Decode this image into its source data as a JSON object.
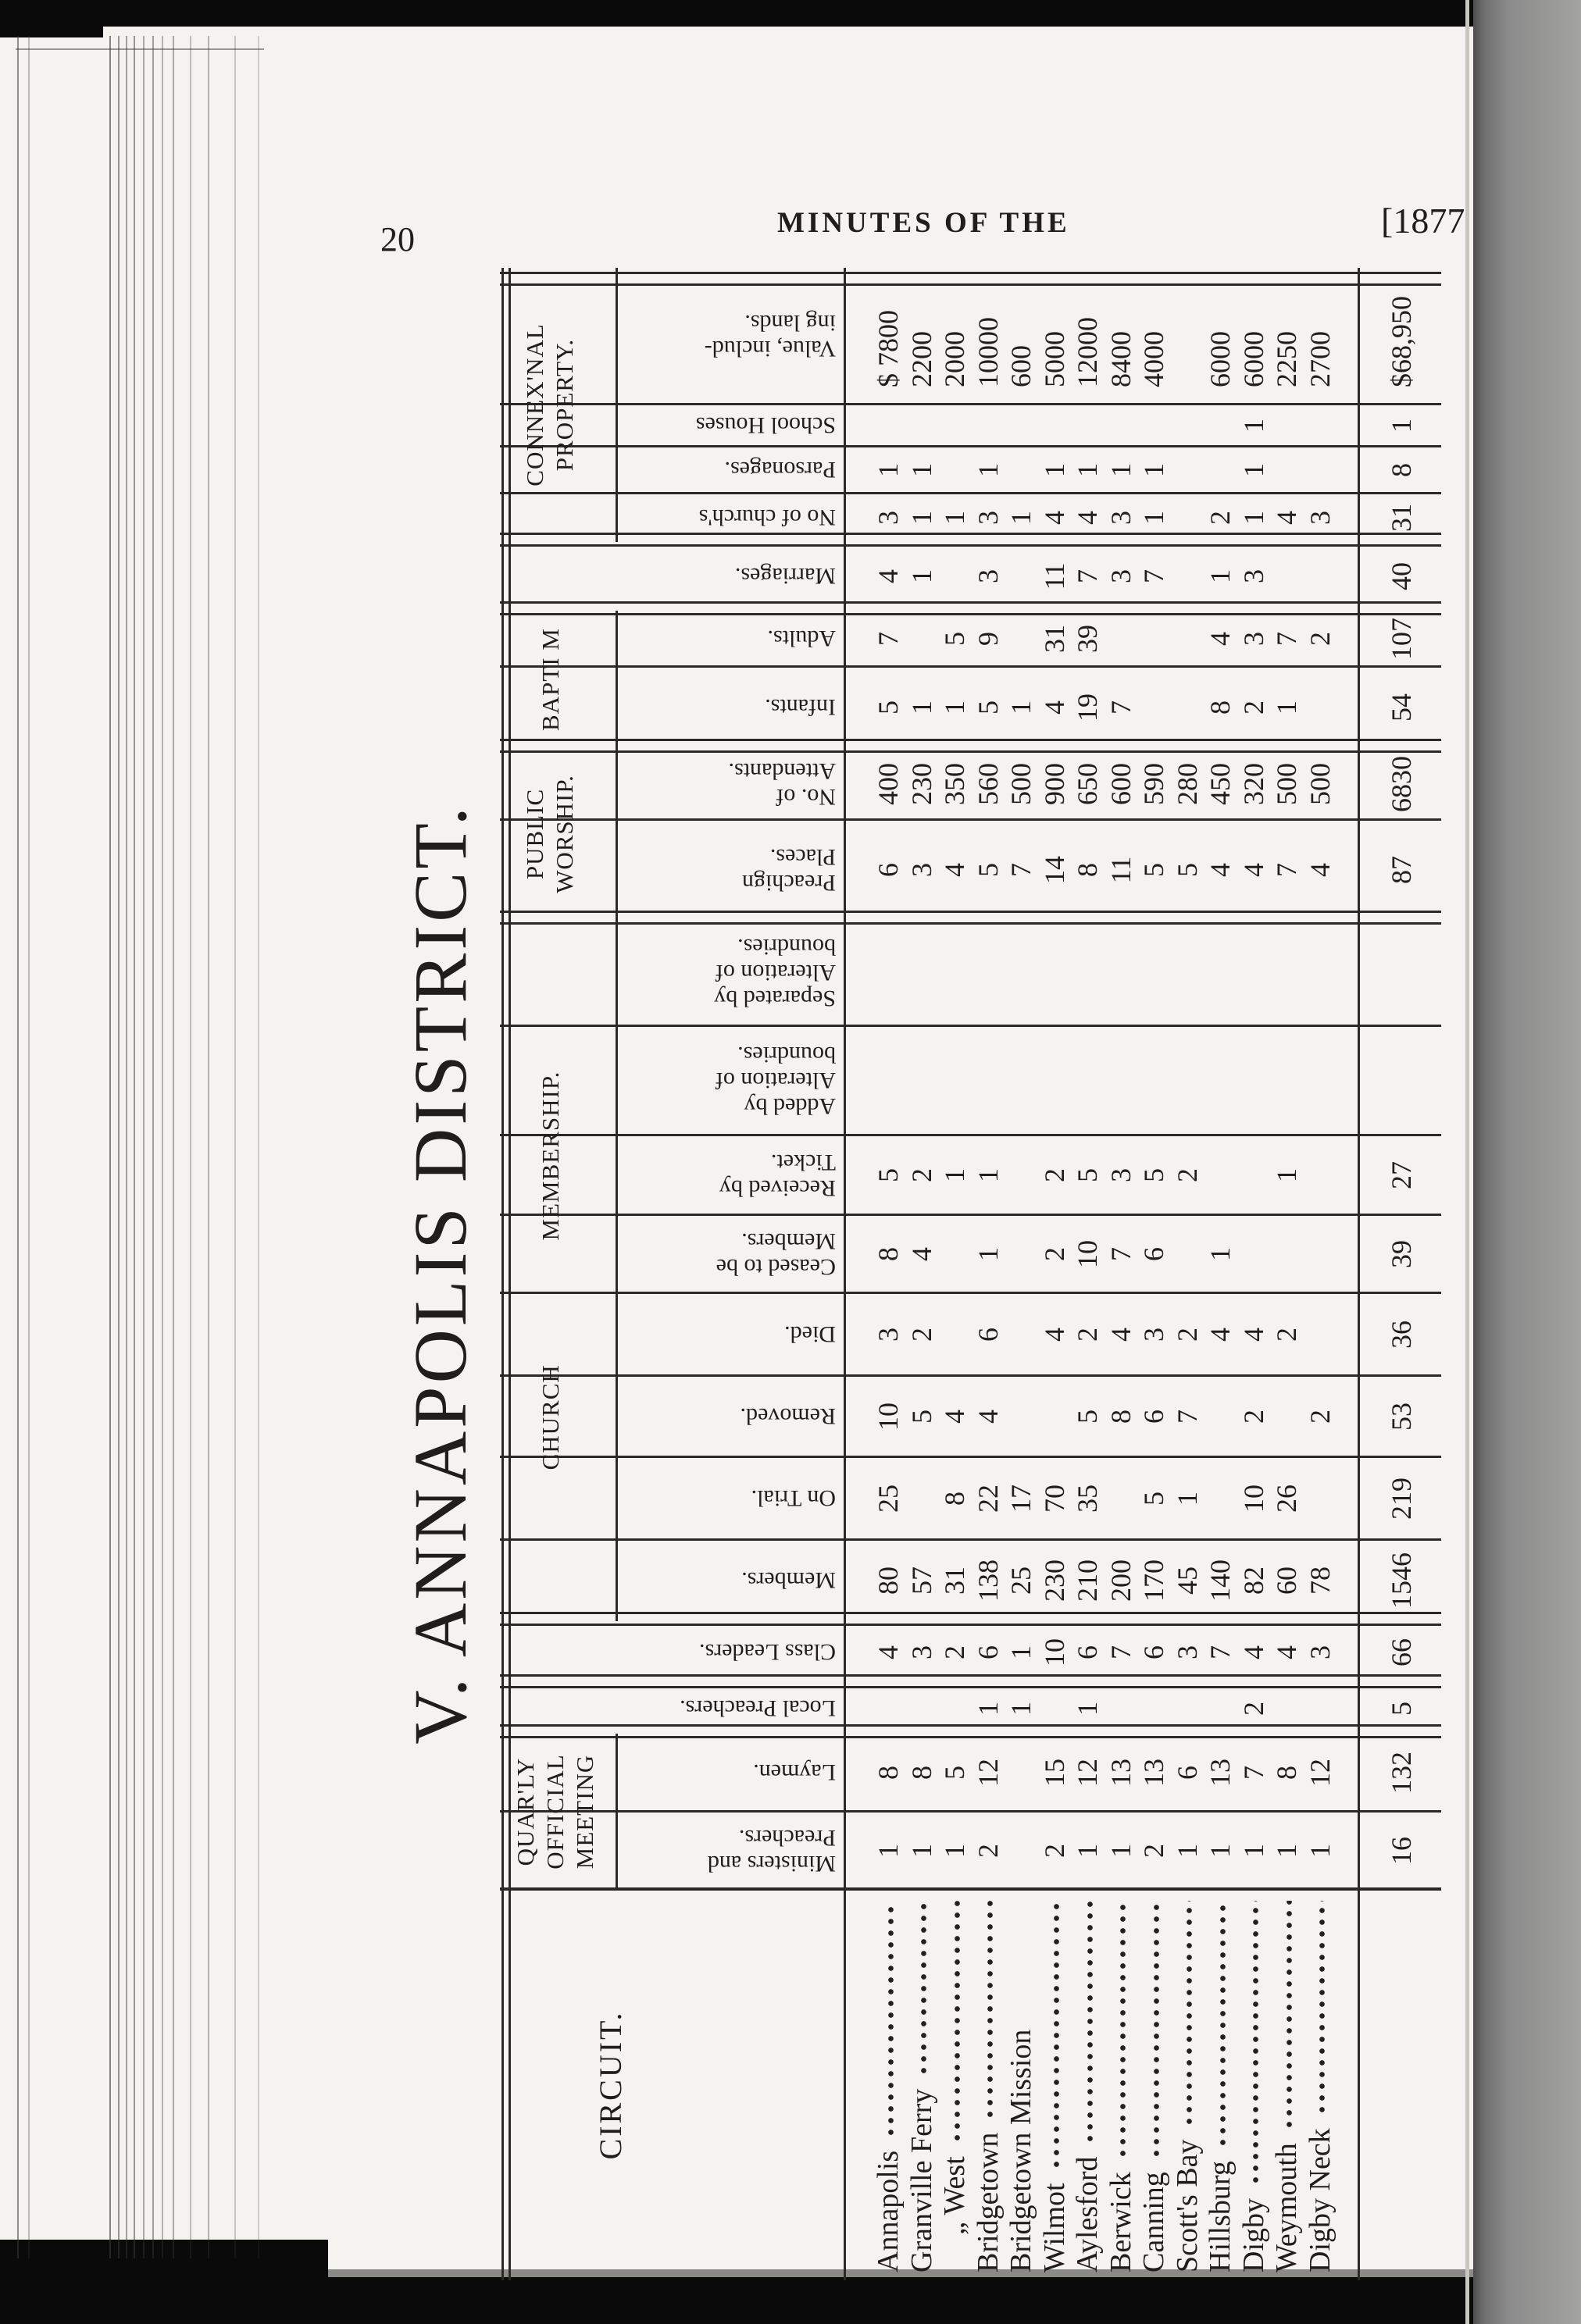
{
  "page": {
    "number": "20",
    "running_title": "MINUTES OF THE",
    "year_ref": "[1877"
  },
  "table": {
    "title": "V. ANNAPOLIS DISTRICT.",
    "groups": [
      {
        "label_lines": [
          "QUAR'LY",
          "OFFICIAL",
          "MEETING"
        ]
      },
      {
        "label_lines": [
          "CHURCH MEMBERSHIP."
        ],
        "wide": true
      },
      {
        "label_lines": [
          "PUBLIC",
          "WORSHIP."
        ]
      },
      {
        "label_lines": [
          "BAPTI M"
        ],
        "single": true
      },
      {
        "label_lines": [
          "CONNEX'NAL",
          "PROPERTY."
        ]
      }
    ],
    "columns": [
      {
        "label_lines": [
          "CIRCUIT."
        ],
        "type": "circuit"
      },
      {
        "label_lines": [
          "Ministers and",
          "Preachers."
        ],
        "group": 0
      },
      {
        "label_lines": [
          "Laymen."
        ],
        "group": 0
      },
      {
        "label_lines": [
          "Local Preachers."
        ],
        "full": true
      },
      {
        "label_lines": [
          "Class Leaders."
        ],
        "full": true
      },
      {
        "label_lines": [
          "Members."
        ],
        "group": 1
      },
      {
        "label_lines": [
          "On Trial."
        ],
        "group": 1
      },
      {
        "label_lines": [
          "Removed."
        ],
        "group": 1
      },
      {
        "label_lines": [
          "Died."
        ],
        "group": 1
      },
      {
        "label_lines": [
          "Ceased to be",
          "Members."
        ],
        "group": 1
      },
      {
        "label_lines": [
          "Received by",
          "Ticket."
        ],
        "group": 1
      },
      {
        "label_lines": [
          "Added by",
          "Alteration of",
          "boundries."
        ],
        "group": 1
      },
      {
        "label_lines": [
          "Separated by",
          "Alteration of",
          "boundries."
        ],
        "group": 1
      },
      {
        "label_lines": [
          "Preachign",
          "Places."
        ],
        "group": 2
      },
      {
        "label_lines": [
          "No. of",
          "Attendants."
        ],
        "group": 2
      },
      {
        "label_lines": [
          "Infants."
        ],
        "group": 3
      },
      {
        "label_lines": [
          "Adults."
        ],
        "group": 3
      },
      {
        "label_lines": [
          "Marriages."
        ],
        "full": true
      },
      {
        "label_lines": [
          "No of church's"
        ],
        "group": 4
      },
      {
        "label_lines": [
          "Parsonages."
        ],
        "group": 4
      },
      {
        "label_lines": [
          "School Houses"
        ],
        "group": 4
      },
      {
        "label_lines": [
          "Value, includ-",
          "ing lands."
        ],
        "group": 4,
        "align": "left"
      }
    ],
    "rows": [
      {
        "circuit": "Annapolis",
        "leader": true,
        "values": [
          "1",
          "8",
          "",
          "4",
          "80",
          "25",
          "10",
          "3",
          "8",
          "5",
          "",
          "",
          "6",
          "400",
          "5",
          "7",
          "4",
          "3",
          "1",
          "",
          "$ 7800"
        ]
      },
      {
        "circuit": "Granville Ferry",
        "leader": true,
        "values": [
          "1",
          "8",
          "",
          "3",
          "57",
          "",
          "5",
          "2",
          "4",
          "2",
          "",
          "",
          "3",
          "230",
          "1",
          "",
          "1",
          "1",
          "1",
          "",
          "2200"
        ]
      },
      {
        "circuit": "„ West",
        "leader": true,
        "indent": true,
        "values": [
          "1",
          "5",
          "",
          "2",
          "31",
          "8",
          "4",
          "",
          "",
          "1",
          "",
          "",
          "4",
          "350",
          "1",
          "5",
          "",
          "1",
          "",
          "",
          "2000"
        ]
      },
      {
        "circuit": "Bridgetown",
        "leader": true,
        "values": [
          "2",
          "12",
          "1",
          "6",
          "138",
          "22",
          "4",
          "6",
          "1",
          "1",
          "",
          "",
          "5",
          "560",
          "5",
          "9",
          "3",
          "3",
          "1",
          "",
          "10000"
        ]
      },
      {
        "circuit": "Bridgetown Mission",
        "leader": false,
        "values": [
          "",
          "",
          "1",
          "1",
          "25",
          "17",
          "",
          "",
          "",
          "",
          "",
          "",
          "7",
          "500",
          "1",
          "",
          "",
          "1",
          "",
          "",
          "600"
        ]
      },
      {
        "circuit": "Wilmot",
        "leader": true,
        "values": [
          "2",
          "15",
          "",
          "10",
          "230",
          "70",
          "",
          "4",
          "2",
          "2",
          "",
          "",
          "14",
          "900",
          "4",
          "31",
          "11",
          "4",
          "1",
          "",
          "5000"
        ]
      },
      {
        "circuit": "Aylesford",
        "leader": true,
        "values": [
          "1",
          "12",
          "1",
          "6",
          "210",
          "35",
          "5",
          "2",
          "10",
          "5",
          "",
          "",
          "8",
          "650",
          "19",
          "39",
          "7",
          "4",
          "1",
          "",
          "12000"
        ]
      },
      {
        "circuit": "Berwick",
        "leader": true,
        "values": [
          "1",
          "13",
          "",
          "7",
          "200",
          "",
          "8",
          "4",
          "7",
          "3",
          "",
          "",
          "11",
          "600",
          "7",
          "",
          "3",
          "3",
          "1",
          "",
          "8400"
        ]
      },
      {
        "circuit": "Canning",
        "leader": true,
        "values": [
          "2",
          "13",
          "",
          "6",
          "170",
          "5",
          "6",
          "3",
          "6",
          "5",
          "",
          "",
          "5",
          "590",
          "",
          "",
          "7",
          "1",
          "1",
          "",
          "4000"
        ]
      },
      {
        "circuit": "Scott's Bay",
        "leader": true,
        "values": [
          "1",
          "6",
          "",
          "3",
          "45",
          "1",
          "7",
          "2",
          "",
          "2",
          "",
          "",
          "5",
          "280",
          "",
          "",
          "",
          "",
          "",
          "",
          ""
        ]
      },
      {
        "circuit": "Hillsburg",
        "leader": true,
        "values": [
          "1",
          "13",
          "",
          "7",
          "140",
          "",
          "",
          "4",
          "1",
          "",
          "",
          "",
          "4",
          "450",
          "8",
          "4",
          "1",
          "2",
          "",
          "",
          "6000"
        ]
      },
      {
        "circuit": "Digby",
        "leader": true,
        "values": [
          "1",
          "7",
          "2",
          "4",
          "82",
          "10",
          "2",
          "4",
          "",
          "",
          "",
          "",
          "4",
          "320",
          "2",
          "3",
          "3",
          "1",
          "1",
          "1",
          "6000"
        ]
      },
      {
        "circuit": "Weymouth",
        "leader": true,
        "values": [
          "1",
          "8",
          "",
          "4",
          "60",
          "26",
          "",
          "2",
          "",
          "1",
          "",
          "",
          "7",
          "500",
          "1",
          "7",
          "",
          "4",
          "",
          "",
          "2250"
        ]
      },
      {
        "circuit": "Digby Neck",
        "leader": true,
        "values": [
          "1",
          "12",
          "",
          "3",
          "78",
          "",
          "2",
          "",
          "",
          "",
          "",
          "",
          "4",
          "500",
          "",
          "2",
          "",
          "3",
          "",
          "",
          "2700"
        ]
      }
    ],
    "totals": [
      "16",
      "132",
      "5",
      "66",
      "1546",
      "219",
      "53",
      "36",
      "39",
      "27",
      "",
      "",
      "87",
      "6830",
      "54",
      "107",
      "40",
      "31",
      "8",
      "1",
      "$68,950"
    ]
  }
}
